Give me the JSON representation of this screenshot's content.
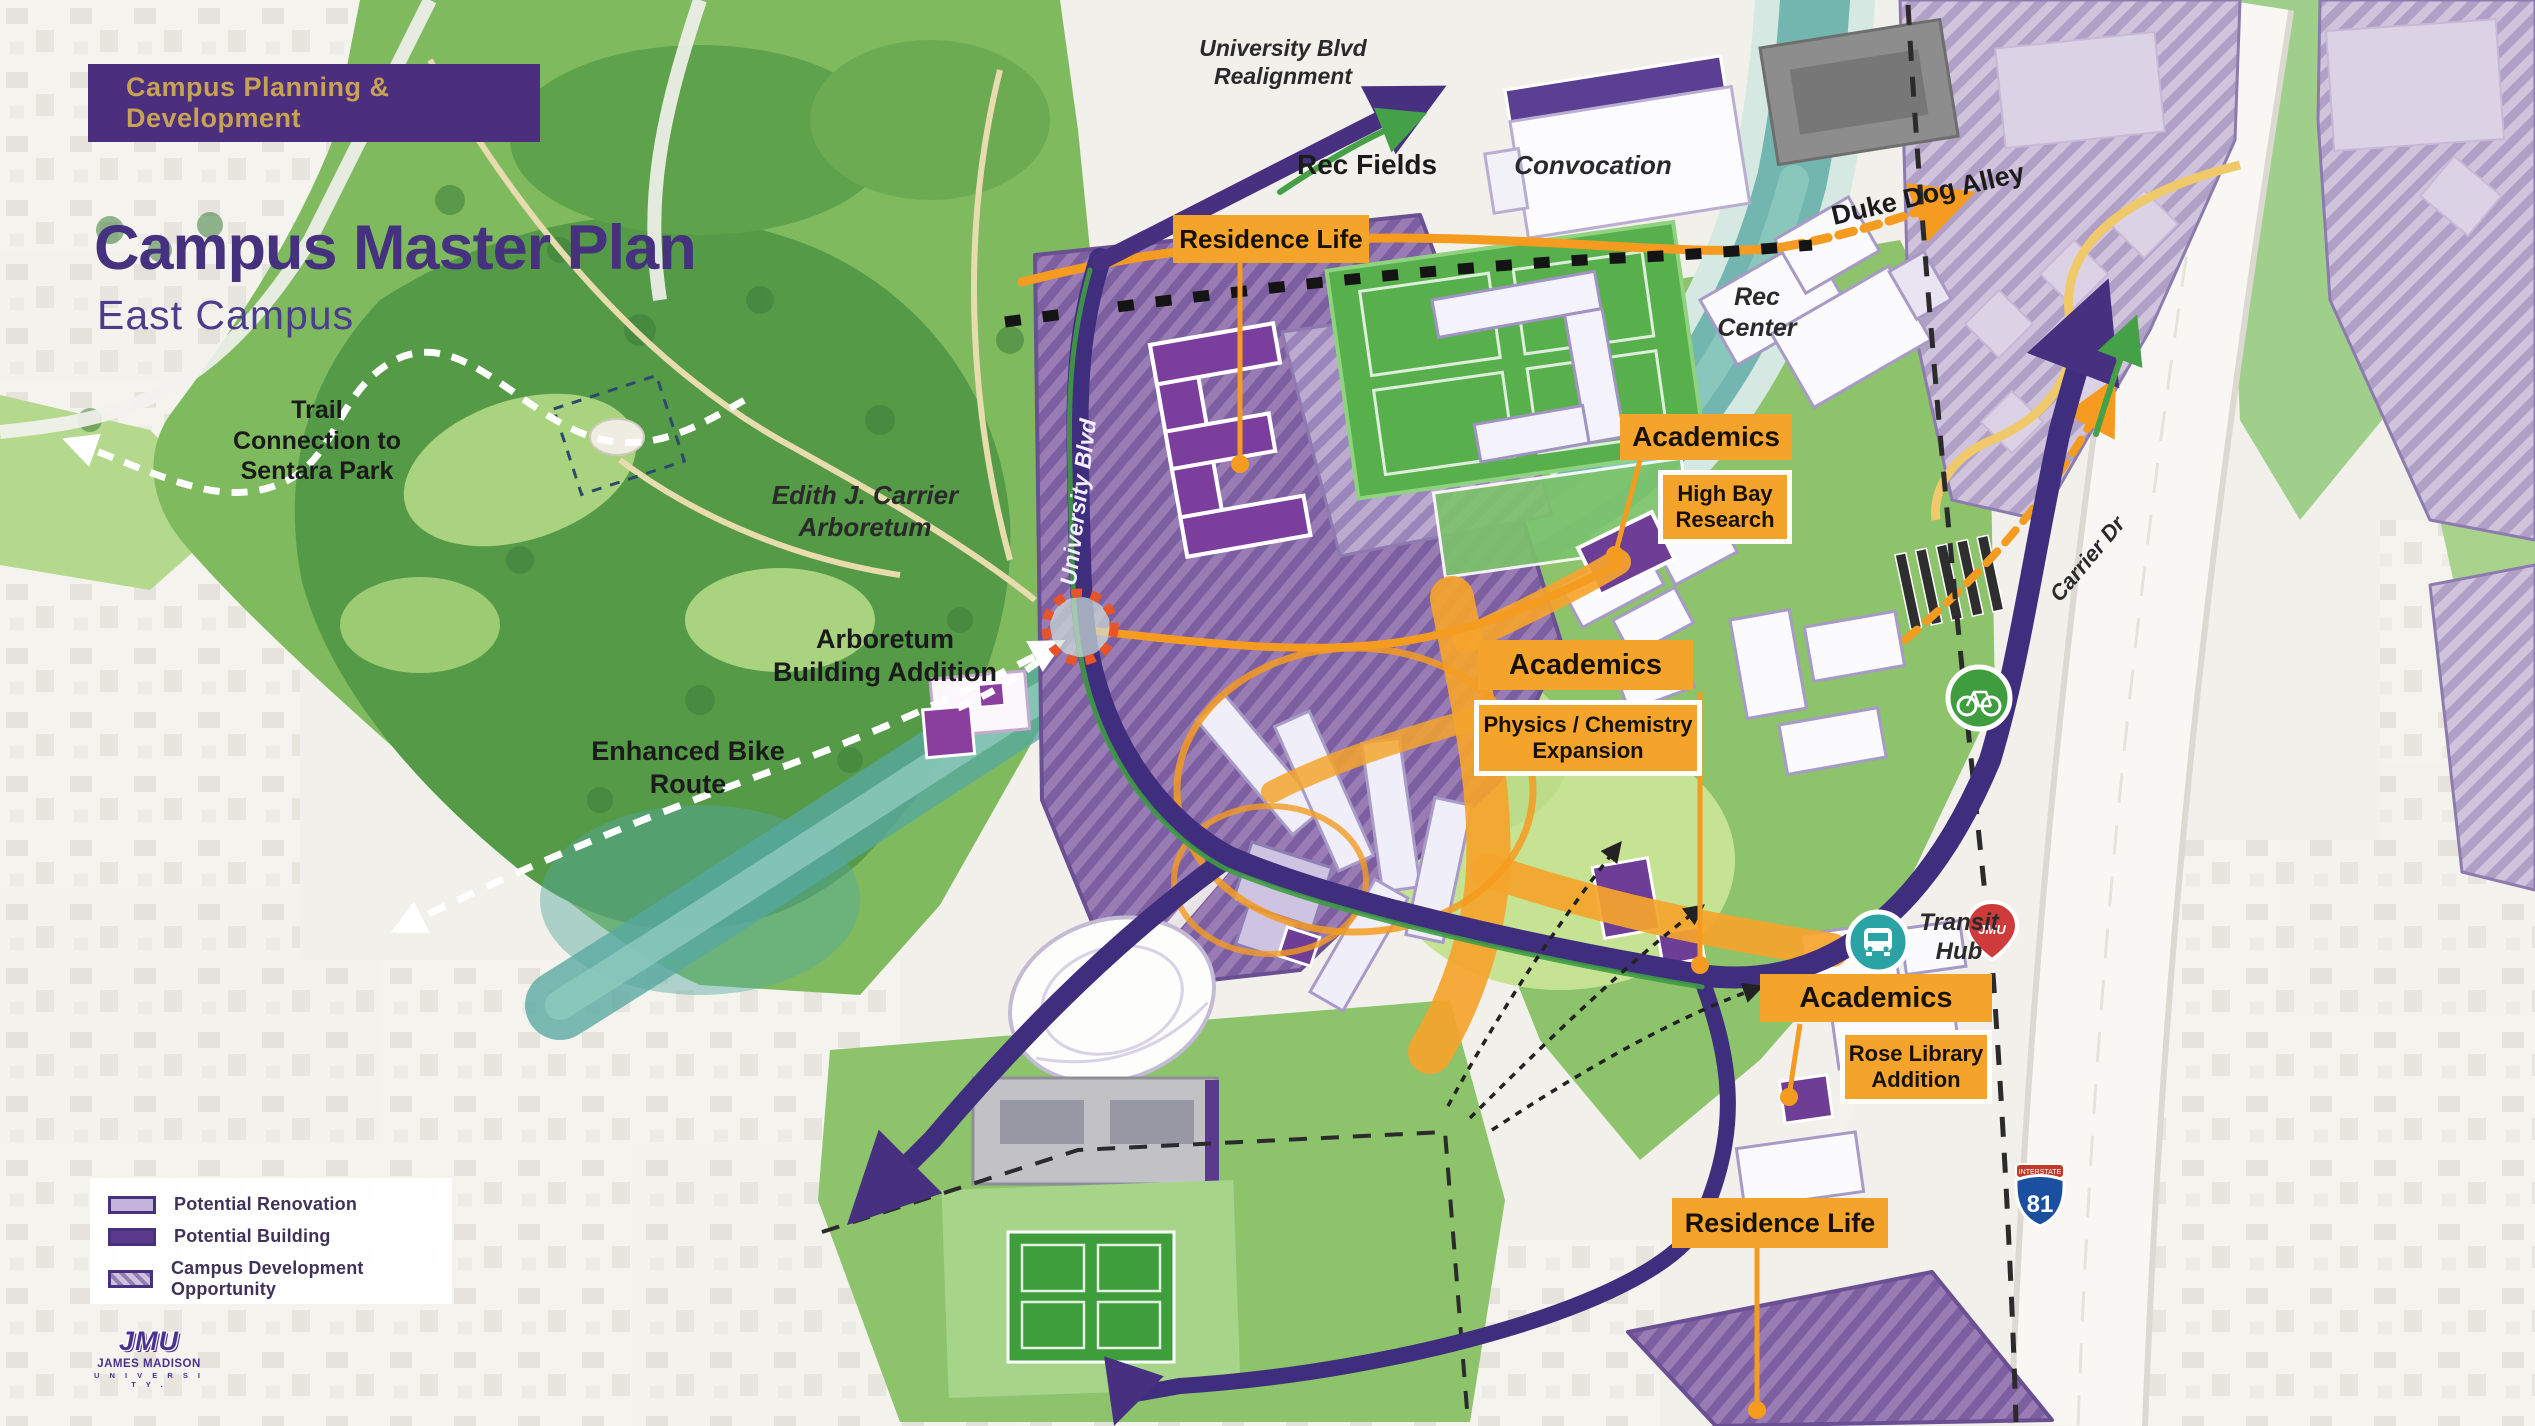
{
  "header": {
    "banner": "Campus Planning & Development",
    "title": "Campus Master Plan",
    "subtitle": "East Campus"
  },
  "map_labels": {
    "trail_connection": "Trail\nConnection to\nSentara Park",
    "arboretum": "Edith J. Carrier\nArboretum",
    "arboretum_addition": "Arboretum\nBuilding Addition",
    "enhanced_bike_route": "Enhanced Bike\nRoute",
    "university_blvd_realignment": "University Blvd\nRealignment",
    "rec_fields": "Rec Fields",
    "convocation": "Convocation",
    "duke_dog_alley": "Duke Dog Alley",
    "rec_center": "Rec\nCenter",
    "university_blvd": "University Blvd",
    "carrier_dr": "Carrier Dr",
    "transit_hub": "Transit\nHub"
  },
  "callouts": {
    "residence_life_north": {
      "label": "Residence Life"
    },
    "academics_high_bay": {
      "label": "Academics",
      "sub": "High Bay\nResearch"
    },
    "academics_physics_chemistry": {
      "label": "Academics",
      "sub": "Physics / Chemistry\nExpansion"
    },
    "academics_rose_library": {
      "label": "Academics",
      "sub": "Rose Library\nAddition"
    },
    "residence_life_south": {
      "label": "Residence Life"
    }
  },
  "legend": {
    "items": [
      {
        "label": "Potential Renovation",
        "type": "renovation"
      },
      {
        "label": "Potential Building",
        "type": "building"
      },
      {
        "label": "Campus Development Opportunity",
        "type": "opportunity"
      }
    ]
  },
  "logo": {
    "acronym": "JMU",
    "name": "JAMES MADISON",
    "suffix": "U N I V E R S I T Y ."
  },
  "markers": {
    "interstate_band": "INTERSTATE",
    "interstate_number": "81",
    "jmu_pin": "JMU"
  },
  "colors": {
    "accent_orange": "#F5A42B",
    "brand_purple": "#46307F",
    "banner_gold": "#C7A254",
    "road_purple": "#3F2D7D",
    "creek_teal": "#57A8A0",
    "field_green": "#4AA53E",
    "hatch_purple": "#9A7CB5"
  }
}
